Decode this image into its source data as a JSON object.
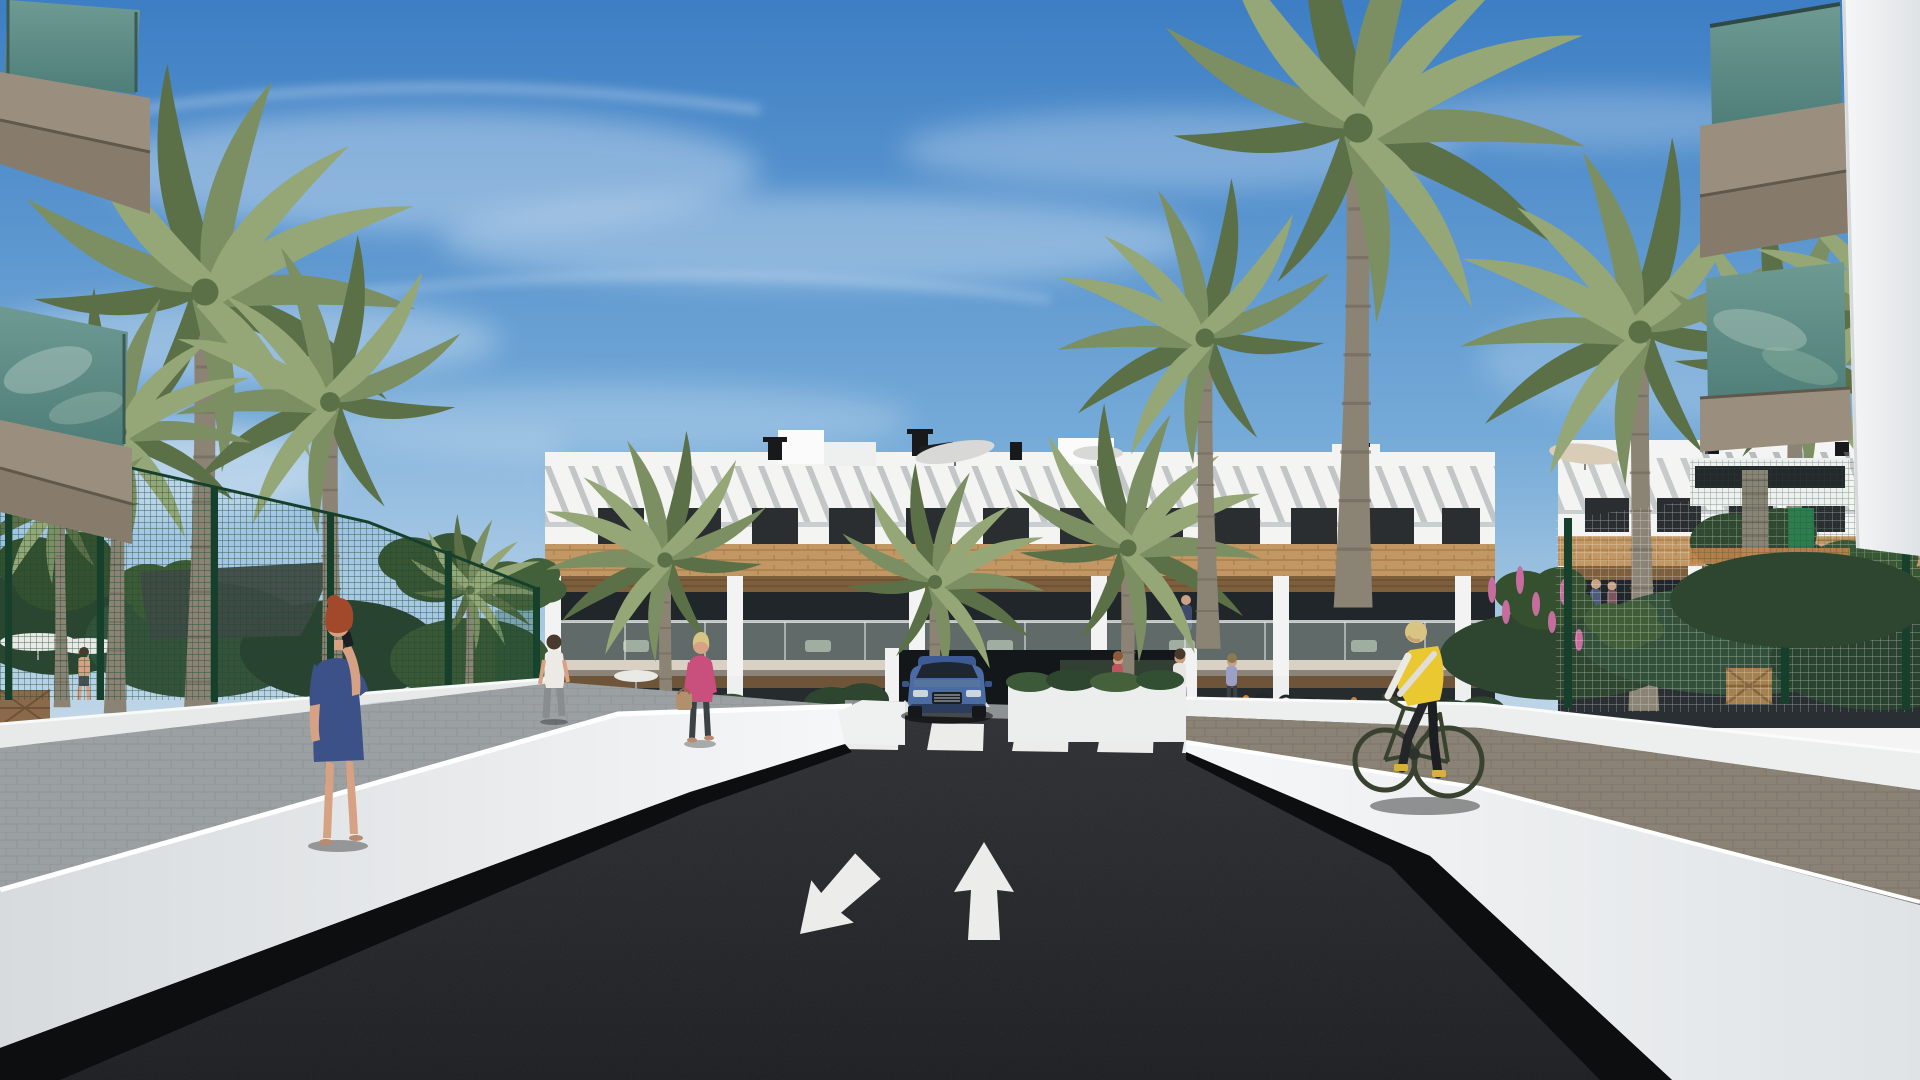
{
  "scene": {
    "type": "3d-architectural-rendering",
    "view": "street-level view of a modern white apartment complex with palm trees",
    "road_markings": {
      "crosswalk_stripe_count": 5,
      "lane_arrows": [
        "toward-viewer-down-left",
        "away-straight-up"
      ]
    },
    "figures": [
      "woman-blue-dress-on-phone",
      "woman-pink-top-with-handbag",
      "man-white-shirt-walking-away",
      "shirtless-man-in-garden",
      "cyclist-yellow-vest",
      "pedestrians-near-bike-racks",
      "balcony-residents"
    ],
    "objects": [
      "apartment-building-center",
      "apartment-wing-right",
      "foreground-balconies-left",
      "foreground-balconies-right",
      "blue-suv-at-driveway",
      "green-mesh-fence",
      "white-mesh-fence",
      "shade-sail",
      "patio-parasols",
      "rooftop-parasols",
      "bike-racks"
    ]
  },
  "palette": {
    "sky_top": "#3d7ec4",
    "sky_mid": "#76abd8",
    "sky_horizon": "#d6e3ec",
    "cloud_white": "#ffffff",
    "building_white": "#f4f5f3",
    "slat_shadow": "#7e868c",
    "window_glass": "#2a2e31",
    "wood_cladding": "#c29763",
    "pergola_soffit": "#7d5f3c",
    "balcony_glass": "#b9c8c2",
    "slab_taupe": "#9a8f7e",
    "glass_teal_light": "#6e9a92",
    "glass_teal_dark": "#4e7e78",
    "fence_green": "#16402c",
    "foliage_dark": "#2e4630",
    "foliage_mid": "#44613c",
    "palm_green": "#7c8f63",
    "palm_green_light": "#95a777",
    "palm_green_dark": "#5c7048",
    "palm_trunk": "#8b8374",
    "road_far": "#2e2f33",
    "road_near": "#1c1d20",
    "road_marking": "#ececea",
    "wall_light": "#f6f7f8",
    "wall_mid": "#d7dbdd",
    "wall_shadow": "#0d0e10",
    "walkway_gray": "#9ba0a3",
    "paver_brown": "#8b8276",
    "grass_green": "#5a7a4a",
    "car_blue": "#4a6ba4",
    "sail_gray": "#3f4a44",
    "parasol_white": "#e9eae6",
    "parasol_tan": "#d9cdb8",
    "skin": "#d7a183",
    "hair_auburn": "#a3492b",
    "hair_blonde": "#d8c584",
    "dress_blue": "#3c5188",
    "jacket_magenta": "#c94f7c",
    "pants_dark": "#3c4146",
    "shirt_white": "#eceae4",
    "vest_yellow": "#e9c832",
    "bike_dark": "#39422f",
    "flower_pink": "#c66d9d",
    "flower_orange": "#d2813f"
  }
}
